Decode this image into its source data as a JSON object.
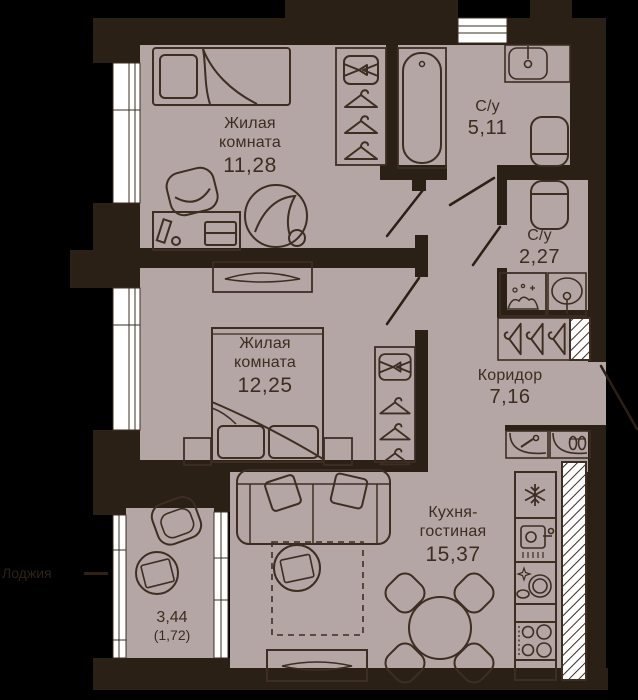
{
  "plan": {
    "rooms": {
      "bedroom1": {
        "name_line1": "Жилая",
        "name_line2": "комната",
        "area": "11,28"
      },
      "bathroom1": {
        "name": "С/у",
        "area": "5,11"
      },
      "bathroom2": {
        "name": "С/у",
        "area": "2,27"
      },
      "bedroom2": {
        "name_line1": "Жилая",
        "name_line2": "комната",
        "area": "12,25"
      },
      "corridor": {
        "name": "Коридор",
        "area": "7,16"
      },
      "kitchen_living": {
        "name_line1": "Кухня-",
        "name_line2": "гостиная",
        "area": "15,37"
      },
      "loggia": {
        "area": "3,44",
        "area_reduced": "(1,72)",
        "outside_label": "Лоджия"
      }
    },
    "colors": {
      "background": "#000000",
      "wall": "#2b2015",
      "floor": "#b3a6a4",
      "furniture_line": "#3c2e23",
      "text": "#3b2d21",
      "outside_text": "#2e2217",
      "window": "#ffffff"
    }
  }
}
